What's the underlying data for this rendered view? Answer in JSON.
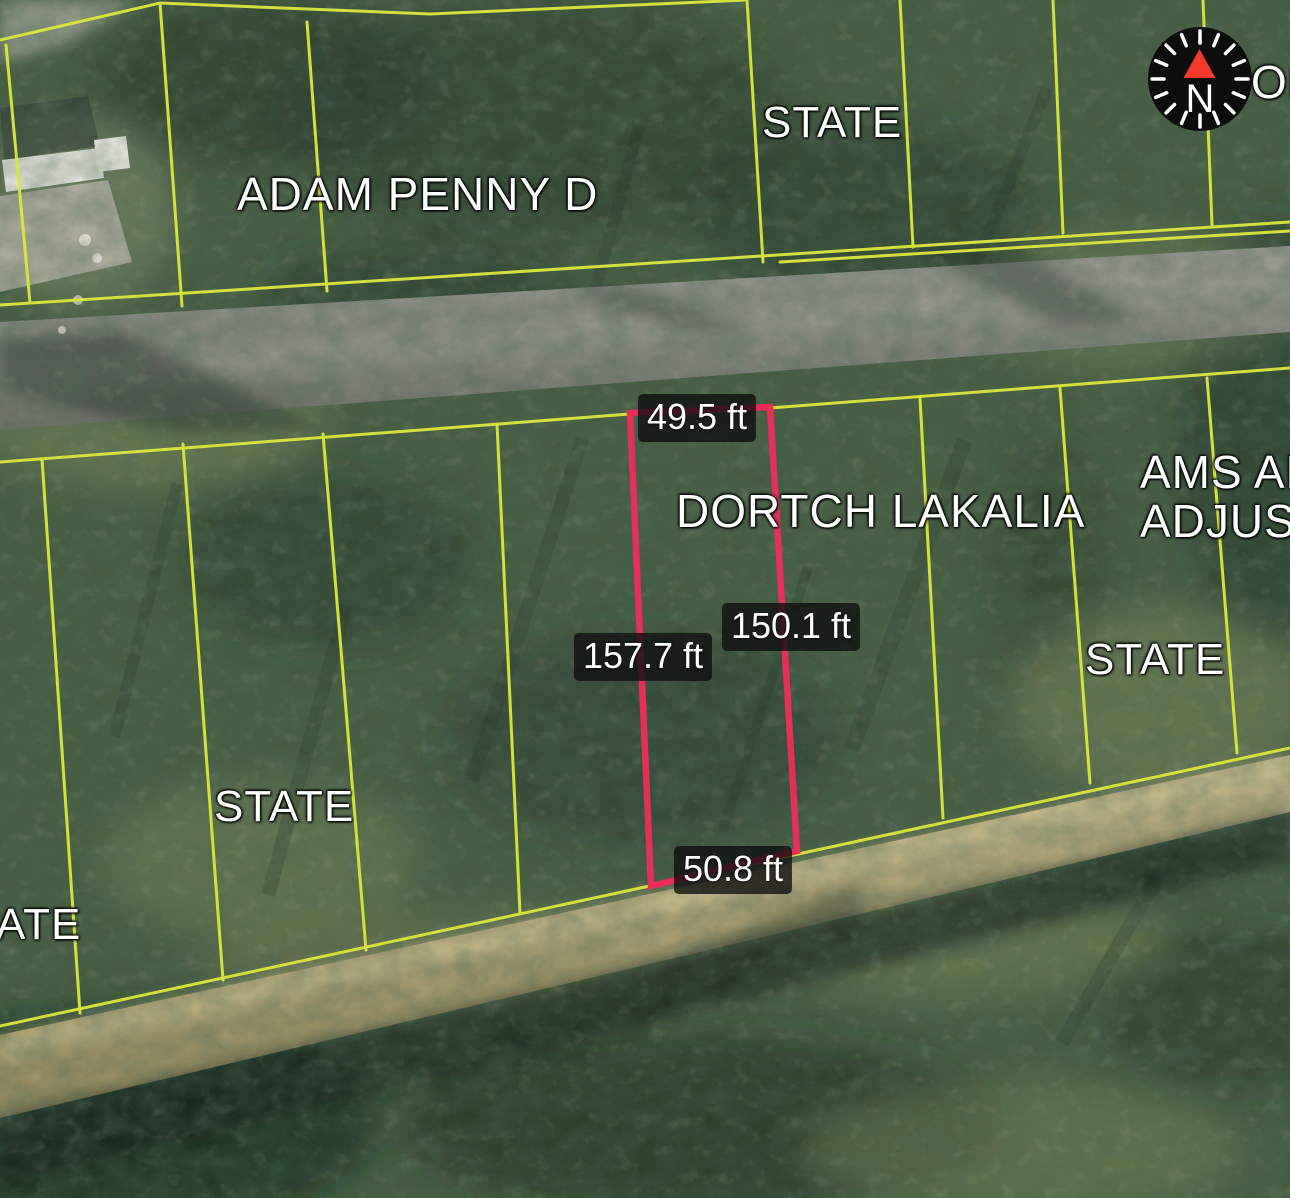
{
  "map": {
    "compass": {
      "cardinal_label": "N"
    },
    "parcel_labels": {
      "adam_penny": "ADAM PENNY D",
      "state_top": "STATE",
      "dortch_lakalia": "DORTCH LAKALIA",
      "ams_line1": "AMS AL",
      "ams_line2": "ADJUST",
      "state_right": "STATE",
      "state_left": "STATE",
      "state_partial_bottom_left": "ATE",
      "partial_top_right": "OF"
    },
    "selected_parcel": {
      "name": "DORTCH LAKALIA",
      "dimensions": {
        "top": "49.5 ft",
        "left": "157.7 ft",
        "right": "150.1 ft",
        "bottom": "50.8 ft"
      }
    },
    "colors": {
      "parcel_line": "#dbe73d",
      "selected_parcel_line": "#e62e58",
      "compass_north_arrow": "#f5392c"
    }
  }
}
